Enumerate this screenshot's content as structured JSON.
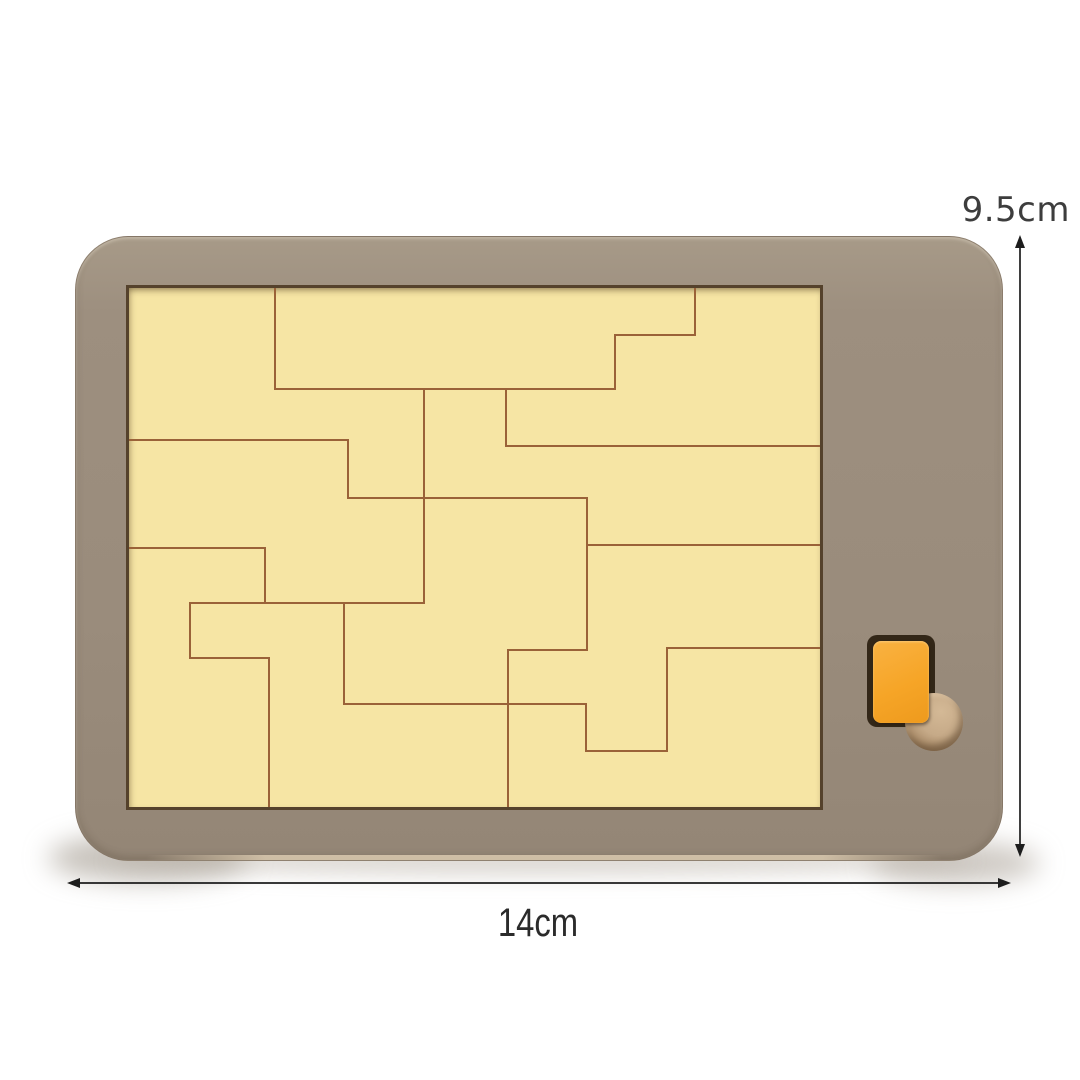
{
  "product": {
    "name": "Wooden puzzle board with orange accent piece and finger hole",
    "height_label": "9.5cm",
    "width_label": "14cm"
  },
  "colors": {
    "background": "#ffffff",
    "frame_wood": "#9b8d7d",
    "tray_fill": "#f6e5a4",
    "tray_border": "#55422c",
    "piece_outline": "#9a6238",
    "accent_piece": "#f6a527",
    "slot": "#332718",
    "finger_hole_wood": "#c6aa88",
    "arrow": "#1d1d1d",
    "dimension_text": "#333333"
  },
  "puzzle": {
    "viewbox_w": 691,
    "viewbox_h": 519,
    "stroke_width": 2,
    "segments": [
      [
        146,
        0,
        146,
        101
      ],
      [
        146,
        101,
        486,
        101
      ],
      [
        486,
        47,
        486,
        101
      ],
      [
        486,
        47,
        566,
        47
      ],
      [
        566,
        0,
        566,
        47
      ],
      [
        295,
        101,
        295,
        315
      ],
      [
        377,
        101,
        377,
        158
      ],
      [
        377,
        158,
        691,
        158
      ],
      [
        0,
        152,
        219,
        152
      ],
      [
        219,
        152,
        219,
        210
      ],
      [
        219,
        210,
        458,
        210
      ],
      [
        458,
        210,
        458,
        362
      ],
      [
        458,
        257,
        691,
        257
      ],
      [
        0,
        260,
        136,
        260
      ],
      [
        136,
        260,
        136,
        315
      ],
      [
        61,
        315,
        295,
        315
      ],
      [
        61,
        315,
        61,
        370
      ],
      [
        61,
        370,
        140,
        370
      ],
      [
        140,
        370,
        140,
        519
      ],
      [
        215,
        315,
        215,
        416
      ],
      [
        215,
        416,
        457,
        416
      ],
      [
        379,
        362,
        379,
        519
      ],
      [
        379,
        362,
        458,
        362
      ],
      [
        457,
        416,
        457,
        463
      ],
      [
        538,
        360,
        691,
        360
      ],
      [
        538,
        360,
        538,
        463
      ],
      [
        457,
        463,
        538,
        463
      ]
    ]
  }
}
